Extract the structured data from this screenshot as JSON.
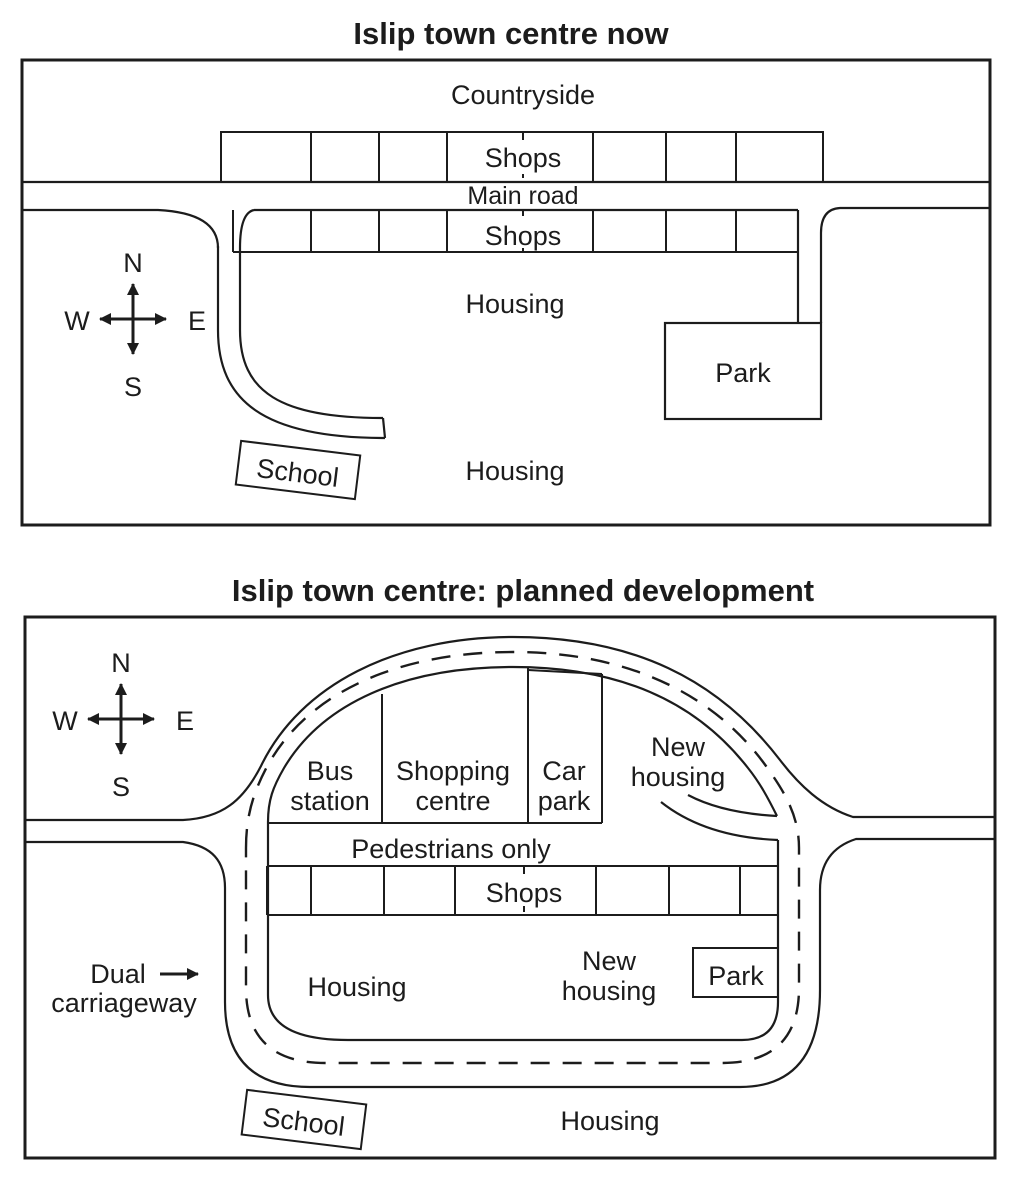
{
  "page": {
    "background": "#ffffff",
    "ink": "#1c1c1c"
  },
  "maps": {
    "now": {
      "title": "Islip town centre now",
      "compass": {
        "n": "N",
        "e": "E",
        "s": "S",
        "w": "W"
      },
      "labels": {
        "countryside": "Countryside",
        "shops_north": "Shops",
        "main_road": "Main road",
        "shops_south": "Shops",
        "housing_centre": "Housing",
        "housing_south": "Housing",
        "park": "Park",
        "school": "School"
      }
    },
    "planned": {
      "title": "Islip town centre: planned development",
      "compass": {
        "n": "N",
        "e": "E",
        "s": "S",
        "w": "W"
      },
      "labels": {
        "bus_station": [
          "Bus",
          "station"
        ],
        "shopping_centre": [
          "Shopping",
          "centre"
        ],
        "car_park": [
          "Car",
          "park"
        ],
        "new_housing_north": [
          "New",
          "housing"
        ],
        "pedestrians_only": "Pedestrians only",
        "shops": "Shops",
        "housing_west": "Housing",
        "new_housing_south": [
          "New",
          "housing"
        ],
        "park": "Park",
        "dual_carriageway": [
          "Dual",
          "carriageway"
        ],
        "housing_south": "Housing",
        "school": "School"
      }
    }
  }
}
